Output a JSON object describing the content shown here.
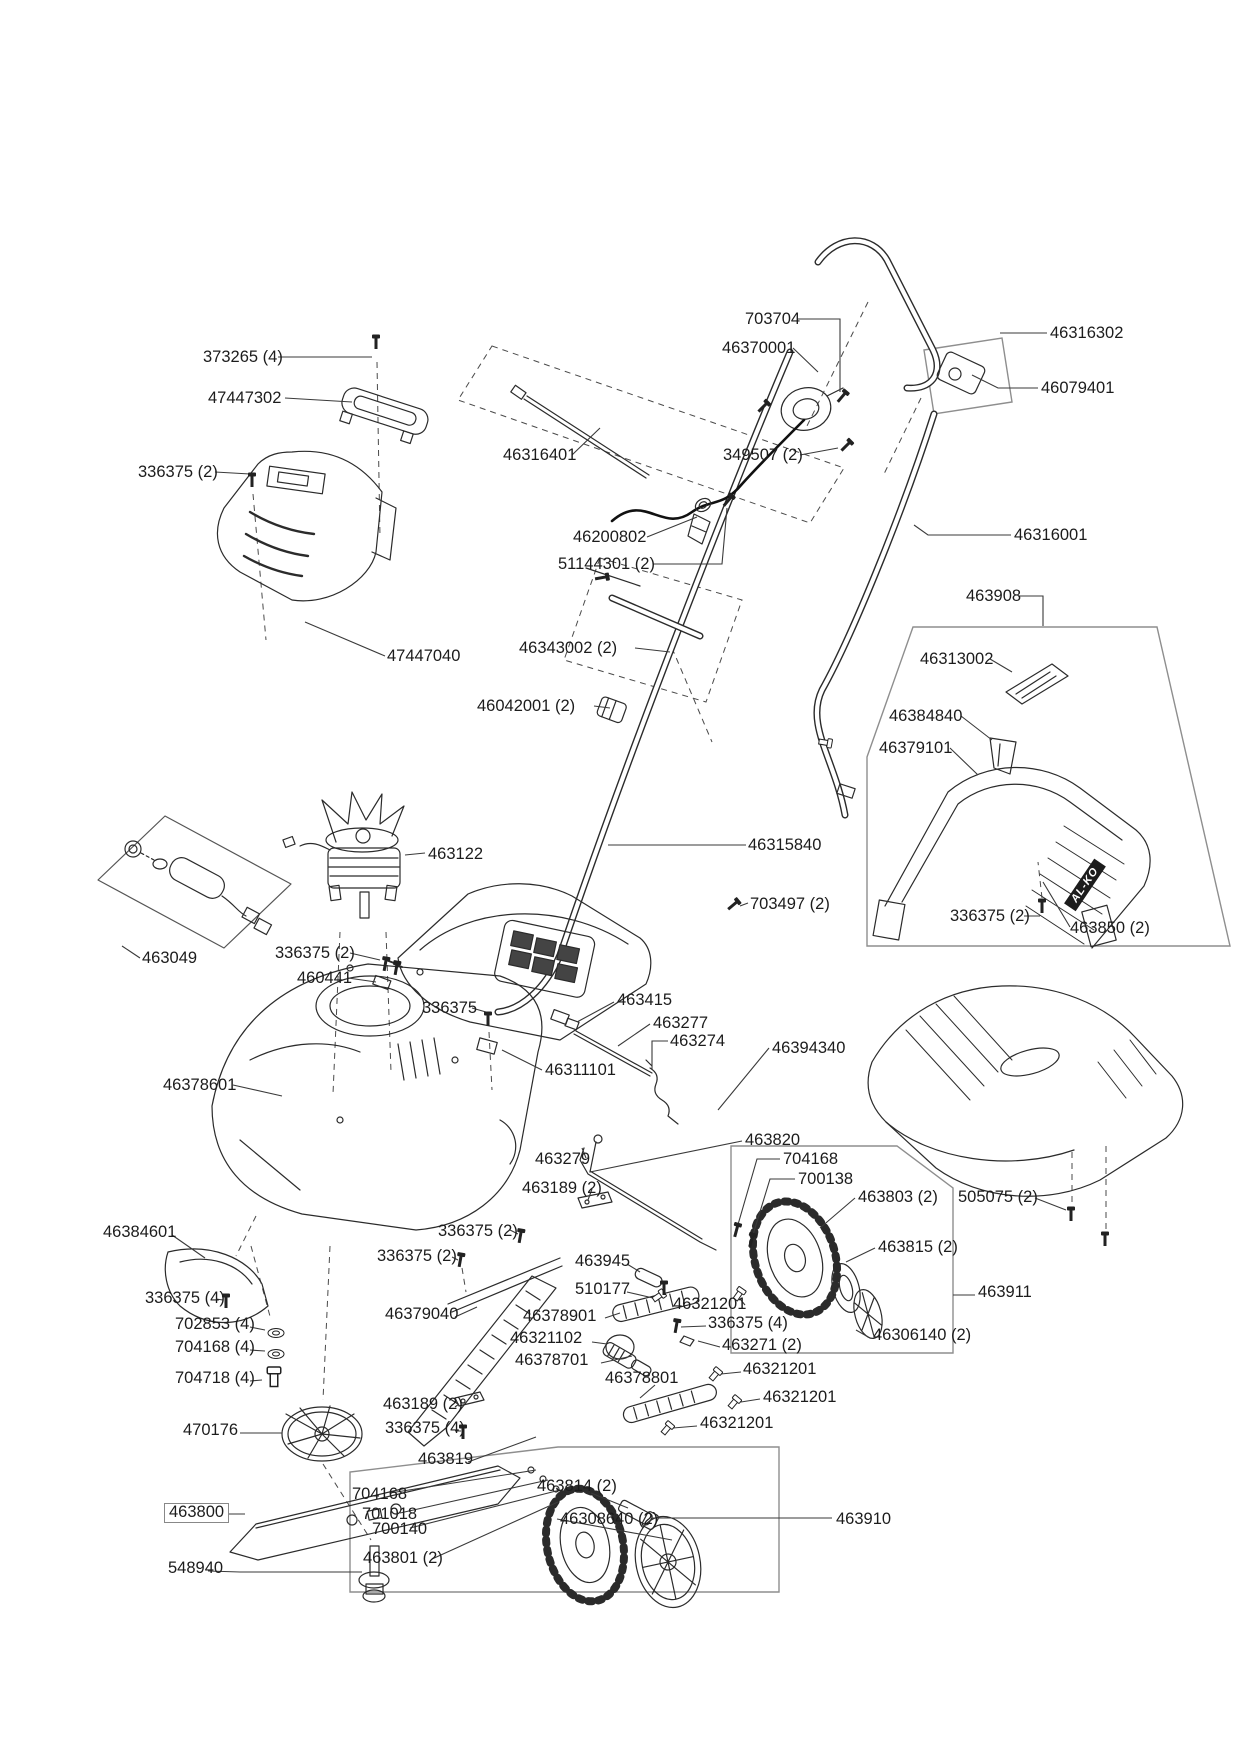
{
  "diagram": {
    "brand_marking": "AL-KO",
    "labels": [
      {
        "text": "373265 (4)",
        "x": 203,
        "y": 349
      },
      {
        "text": "47447302",
        "x": 208,
        "y": 390
      },
      {
        "text": "336375 (2)",
        "x": 138,
        "y": 464
      },
      {
        "text": "47447040",
        "x": 387,
        "y": 648
      },
      {
        "text": "703704",
        "x": 745,
        "y": 311
      },
      {
        "text": "46370001",
        "x": 722,
        "y": 340
      },
      {
        "text": "46316302",
        "x": 1050,
        "y": 325
      },
      {
        "text": "46079401",
        "x": 1041,
        "y": 380
      },
      {
        "text": "46316401",
        "x": 503,
        "y": 447
      },
      {
        "text": "349507 (2)",
        "x": 723,
        "y": 447
      },
      {
        "text": "46200802",
        "x": 573,
        "y": 529
      },
      {
        "text": "51144301 (2)",
        "x": 558,
        "y": 556
      },
      {
        "text": "46316001",
        "x": 1014,
        "y": 527
      },
      {
        "text": "463908",
        "x": 966,
        "y": 588
      },
      {
        "text": "46313002",
        "x": 920,
        "y": 651
      },
      {
        "text": "46384840",
        "x": 889,
        "y": 708
      },
      {
        "text": "46379101",
        "x": 879,
        "y": 740
      },
      {
        "text": "46343002 (2)",
        "x": 519,
        "y": 640
      },
      {
        "text": "46042001 (2)",
        "x": 477,
        "y": 698
      },
      {
        "text": "46315840",
        "x": 748,
        "y": 837
      },
      {
        "text": "703497 (2)",
        "x": 750,
        "y": 896
      },
      {
        "text": "336375 (2)",
        "x": 950,
        "y": 908
      },
      {
        "text": "463850 (2)",
        "x": 1070,
        "y": 920
      },
      {
        "text": "463122",
        "x": 428,
        "y": 846
      },
      {
        "text": "463049",
        "x": 142,
        "y": 950
      },
      {
        "text": "336375 (2)",
        "x": 275,
        "y": 945
      },
      {
        "text": "460441",
        "x": 297,
        "y": 970
      },
      {
        "text": "336375",
        "x": 422,
        "y": 1000
      },
      {
        "text": "463415",
        "x": 617,
        "y": 992
      },
      {
        "text": "463277",
        "x": 653,
        "y": 1015
      },
      {
        "text": "463274",
        "x": 670,
        "y": 1033
      },
      {
        "text": "46394340",
        "x": 772,
        "y": 1040
      },
      {
        "text": "46311101",
        "x": 545,
        "y": 1062
      },
      {
        "text": "46378601",
        "x": 163,
        "y": 1077
      },
      {
        "text": "463820",
        "x": 745,
        "y": 1132
      },
      {
        "text": "704168",
        "x": 783,
        "y": 1151
      },
      {
        "text": "700138",
        "x": 798,
        "y": 1171
      },
      {
        "text": "463803 (2)",
        "x": 858,
        "y": 1189
      },
      {
        "text": "505075 (2)",
        "x": 958,
        "y": 1189
      },
      {
        "text": "463815 (2)",
        "x": 878,
        "y": 1239
      },
      {
        "text": "463279",
        "x": 535,
        "y": 1151
      },
      {
        "text": "463189 (2)",
        "x": 522,
        "y": 1180
      },
      {
        "text": "336375 (2)",
        "x": 438,
        "y": 1223
      },
      {
        "text": "336375 (2)",
        "x": 377,
        "y": 1248
      },
      {
        "text": "46384601",
        "x": 103,
        "y": 1224
      },
      {
        "text": "336375 (4)",
        "x": 145,
        "y": 1290
      },
      {
        "text": "702853 (4)",
        "x": 175,
        "y": 1316
      },
      {
        "text": "704168 (4)",
        "x": 175,
        "y": 1339
      },
      {
        "text": "704718 (4)",
        "x": 175,
        "y": 1370
      },
      {
        "text": "470176",
        "x": 183,
        "y": 1422
      },
      {
        "text": "463945",
        "x": 575,
        "y": 1253
      },
      {
        "text": "510177",
        "x": 575,
        "y": 1281
      },
      {
        "text": "46321201",
        "x": 673,
        "y": 1296
      },
      {
        "text": "46378901",
        "x": 523,
        "y": 1308
      },
      {
        "text": "336375 (4)",
        "x": 708,
        "y": 1315
      },
      {
        "text": "46321102",
        "x": 510,
        "y": 1330
      },
      {
        "text": "463271 (2)",
        "x": 722,
        "y": 1337
      },
      {
        "text": "46378701",
        "x": 515,
        "y": 1352
      },
      {
        "text": "46378801",
        "x": 605,
        "y": 1370
      },
      {
        "text": "46321201",
        "x": 743,
        "y": 1361
      },
      {
        "text": "46321201",
        "x": 763,
        "y": 1389
      },
      {
        "text": "46321201",
        "x": 700,
        "y": 1415
      },
      {
        "text": "463911",
        "x": 978,
        "y": 1284
      },
      {
        "text": "46306140 (2)",
        "x": 873,
        "y": 1327
      },
      {
        "text": "46379040",
        "x": 385,
        "y": 1306
      },
      {
        "text": "463189 (2)",
        "x": 383,
        "y": 1396
      },
      {
        "text": "336375 (4)",
        "x": 385,
        "y": 1420
      },
      {
        "text": "463819",
        "x": 418,
        "y": 1451
      },
      {
        "text": "463800",
        "x": 164,
        "y": 1503,
        "boxed": true
      },
      {
        "text": "548940",
        "x": 168,
        "y": 1560
      },
      {
        "text": "704168",
        "x": 352,
        "y": 1486
      },
      {
        "text": "701018",
        "x": 362,
        "y": 1506
      },
      {
        "text": "700140",
        "x": 372,
        "y": 1521
      },
      {
        "text": "463801 (2)",
        "x": 363,
        "y": 1550
      },
      {
        "text": "463814 (2)",
        "x": 537,
        "y": 1478
      },
      {
        "text": "46308640 (2)",
        "x": 560,
        "y": 1511
      },
      {
        "text": "463910",
        "x": 836,
        "y": 1511
      }
    ]
  }
}
